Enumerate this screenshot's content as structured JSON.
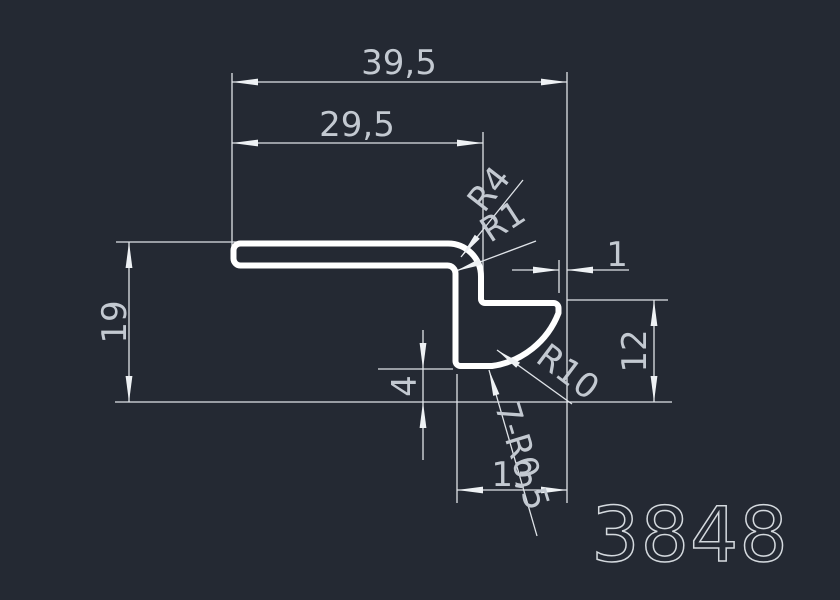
{
  "drawing": {
    "type": "cad-profile-cross-section",
    "drawing_number": "3848"
  },
  "colors": {
    "background": "#242933",
    "profile_line": "#ffffff",
    "dimension_line": "#dfe3e8",
    "text": "#c3c9d1"
  },
  "labels": {
    "total_width": "39,5",
    "upper_width": "29,5",
    "outer_radius": "R4",
    "inner_radius": "R1",
    "step": "1",
    "total_height": "19",
    "right_height": "12",
    "foot_height": "4",
    "concave_radius": "R10",
    "corner_note": "7-R0,5",
    "foot_width": "13",
    "drawing_number": "3848"
  },
  "values": {
    "total_width": 39.5,
    "upper_width": 29.5,
    "total_height": 19,
    "right_height": 12,
    "foot_height": 4,
    "foot_width": 13,
    "step": 1,
    "outer_radius": 4,
    "inner_radius": 1,
    "concave_radius": 10,
    "small_corner_radius": 0.5,
    "small_corner_count": 7
  }
}
